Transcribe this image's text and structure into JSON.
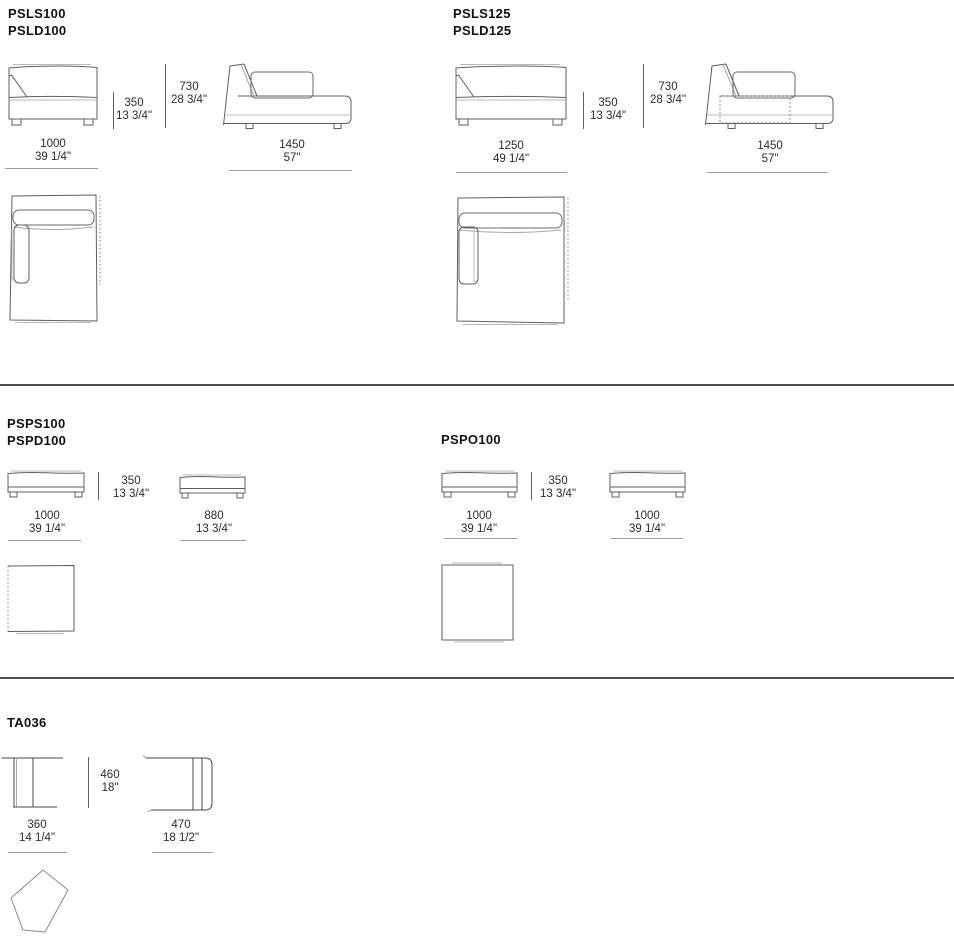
{
  "document": {
    "divider_color": "#4f4f4f",
    "line_color": "#5f5f5f",
    "shadow_gray": "#b9b9b9"
  },
  "section1": {
    "left": {
      "code1": "PSLS100",
      "code2": "PSLD100",
      "front": {
        "seat_height_mm": "350",
        "seat_height_in": "13 3/4\"",
        "total_height_mm": "730",
        "total_height_in": "28 3/4\"",
        "width_mm": "1000",
        "width_in": "39 1/4\""
      },
      "side": {
        "depth_mm": "1450",
        "depth_in": "57\""
      }
    },
    "right": {
      "code1": "PSLS125",
      "code2": "PSLD125",
      "front": {
        "seat_height_mm": "350",
        "seat_height_in": "13 3/4\"",
        "total_height_mm": "730",
        "total_height_in": "28 3/4\"",
        "width_mm": "1250",
        "width_in": "49 1/4\""
      },
      "side": {
        "depth_mm": "1450",
        "depth_in": "57\""
      }
    }
  },
  "section2": {
    "left": {
      "code1": "PSPS100",
      "code2": "PSPD100",
      "height_mm": "350",
      "height_in": "13 3/4\"",
      "front1": {
        "width_mm": "1000",
        "width_in": "39 1/4\""
      },
      "front2": {
        "width_mm": "880",
        "width_in": "13 3/4\""
      }
    },
    "right": {
      "code1": "PSPO100",
      "height_mm": "350",
      "height_in": "13 3/4\"",
      "front1": {
        "width_mm": "1000",
        "width_in": "39 1/4\""
      },
      "front2": {
        "width_mm": "1000",
        "width_in": "39 1/4\""
      }
    }
  },
  "section3": {
    "code1": "TA036",
    "height_mm": "460",
    "height_in": "18\"",
    "front1": {
      "width_mm": "360",
      "width_in": "14 1/4\""
    },
    "front2": {
      "width_mm": "470",
      "width_in": "18 1/2\""
    }
  }
}
